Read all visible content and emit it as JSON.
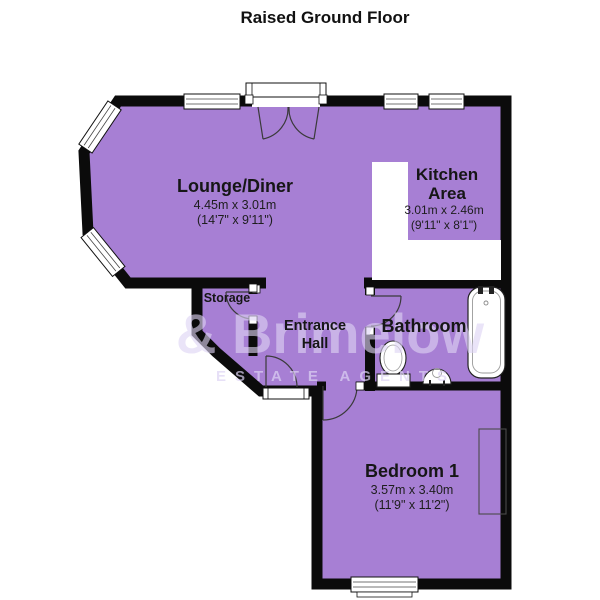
{
  "title": "Raised Ground Floor",
  "watermark": {
    "line1": "& Brimelow",
    "line2": "ESTATE AGENTS"
  },
  "colors": {
    "room_fill": "#a77fd4",
    "wall": "#0b0b0b",
    "fixture_outline": "#222222",
    "watermark": "#ded4f4"
  },
  "rooms": {
    "lounge": {
      "name": "Lounge/Diner",
      "size_m": "4.45m x 3.01m",
      "size_ft": "(14'7\" x 9'11\")"
    },
    "kitchen": {
      "name_line1": "Kitchen",
      "name_line2": "Area",
      "size_m": "3.01m x 2.46m",
      "size_ft": "(9'11\" x 8'1\")"
    },
    "storage": {
      "name": "Storage"
    },
    "hall": {
      "name_line1": "Entrance",
      "name_line2": "Hall"
    },
    "bathroom": {
      "name": "Bathroom"
    },
    "bedroom": {
      "name": "Bedroom 1",
      "size_m": "3.57m x 3.40m",
      "size_ft": "(11'9\" x 11'2\")"
    }
  }
}
